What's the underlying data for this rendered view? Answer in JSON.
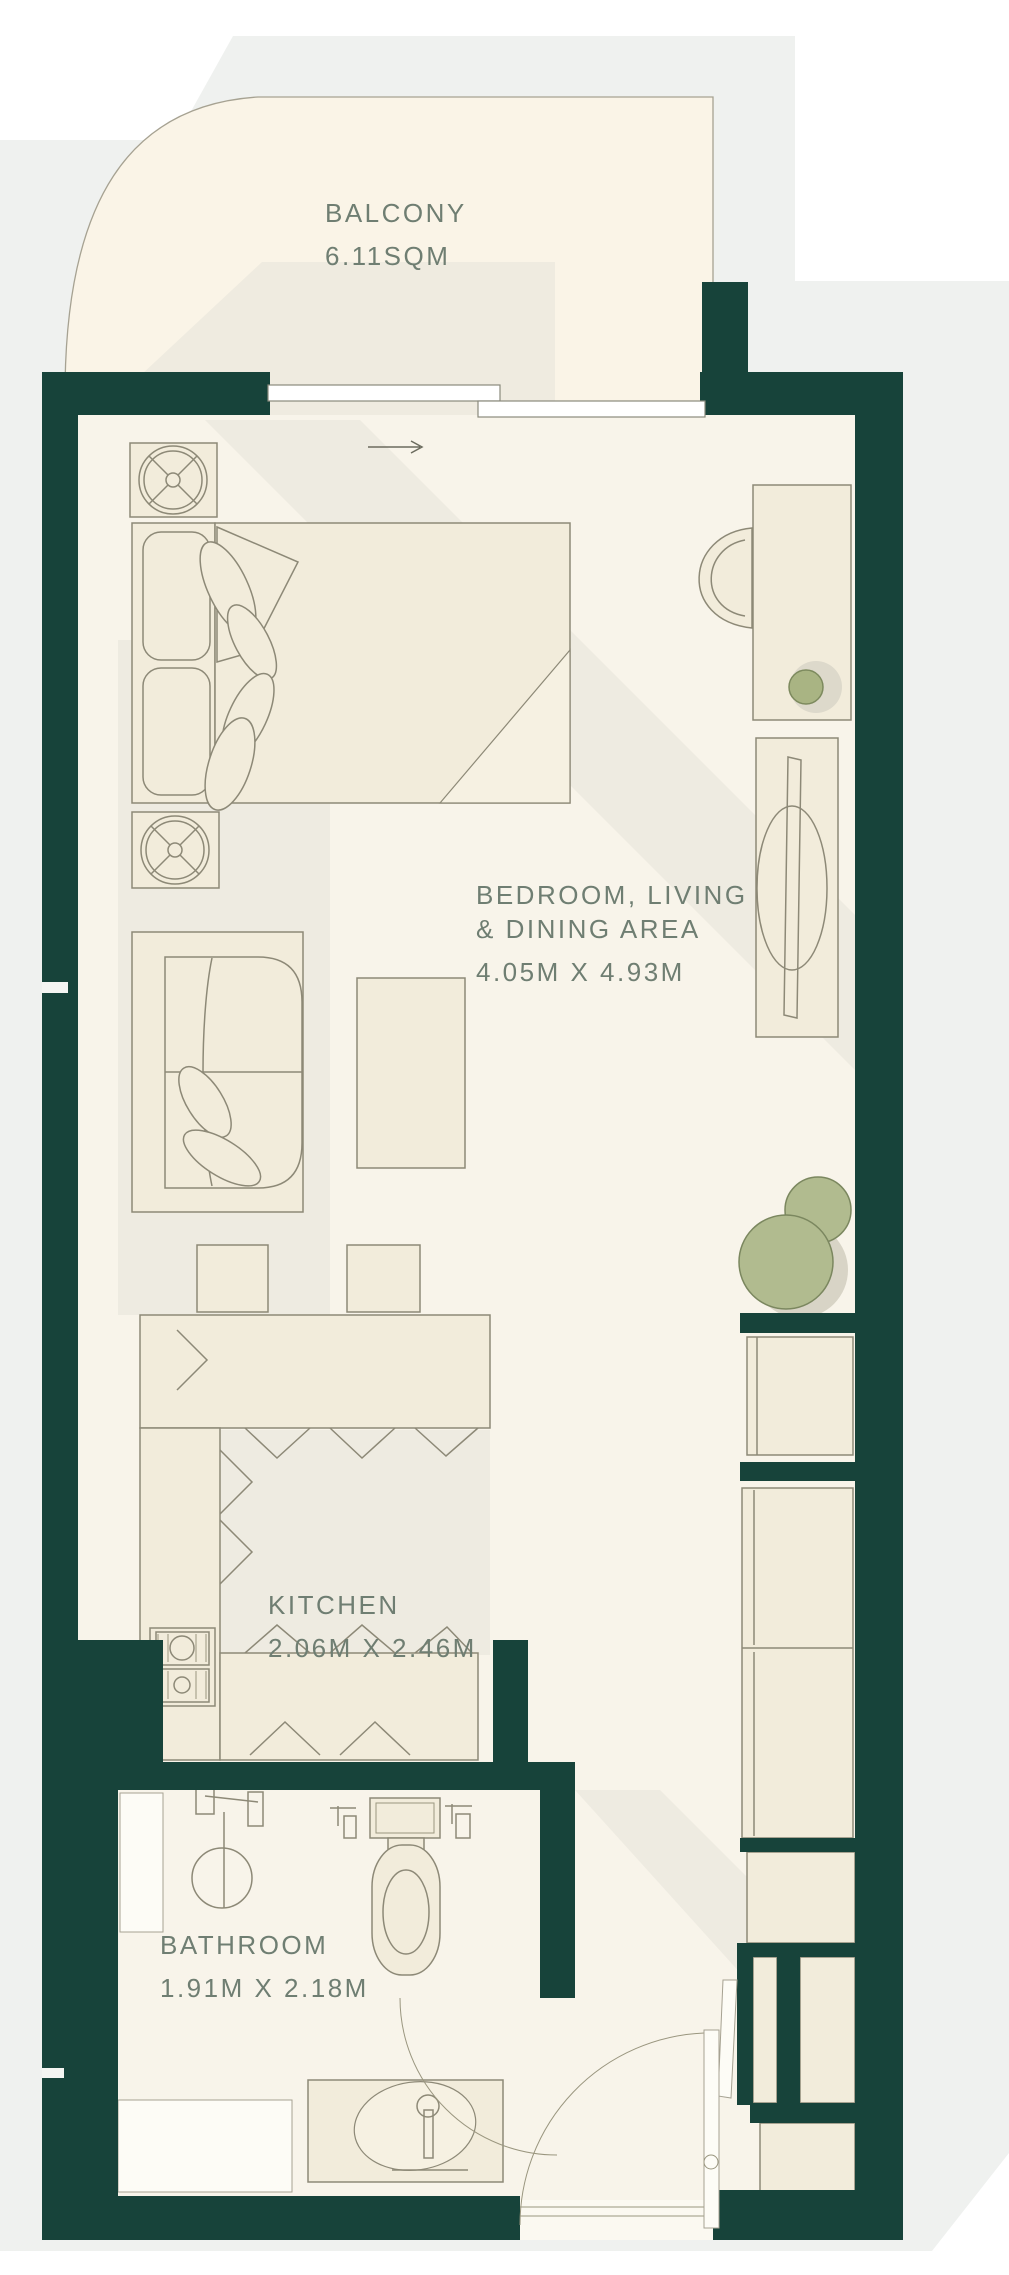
{
  "plan": {
    "kind": "residential floor plan",
    "labels": {
      "balcony": {
        "name": "BALCONY",
        "area": "6.11SQM"
      },
      "bedroom": {
        "line1": "BEDROOM, LIVING",
        "line2": "& DINING AREA",
        "dims": "4.05M X 4.93M"
      },
      "kitchen": {
        "name": "KITCHEN",
        "dims": "2.06M X 2.46M"
      },
      "bathroom": {
        "name": "BATHROOM",
        "dims": "1.91M X 2.18M"
      }
    },
    "colors": {
      "wall": "#17433a",
      "background": "#eff1ef",
      "balcony_floor": "#faf4e7",
      "room_floor": "#f8f4ea",
      "furniture_fill": "#f2ecdb",
      "furniture_stroke": "#8d8977",
      "label_text": "#6f7e72",
      "plant_green": "#b1bb8f",
      "accent_knob": "#a9b483"
    },
    "furniture": [
      "double-bed",
      "pillows",
      "bedside-fan-table",
      "desk",
      "desk-chair",
      "tv-console",
      "sofa",
      "coffee-table",
      "bar-stools",
      "kitchen-island",
      "stove",
      "lower-counter",
      "wardrobes",
      "storage-closets",
      "plant",
      "toilet",
      "shower",
      "vanity-sink",
      "sliding-balcony-door",
      "entry-door",
      "bathroom-door"
    ]
  }
}
